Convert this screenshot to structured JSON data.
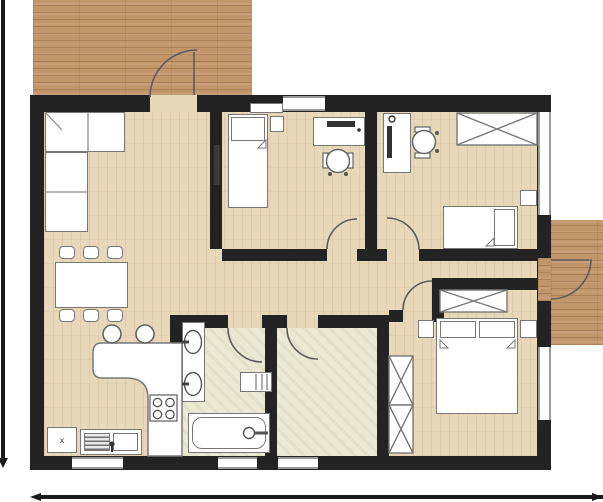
{
  "appliance": {
    "label": "x"
  },
  "colors": {
    "wall": "#232323",
    "deck": "#c2966b",
    "floor": "#e8d8ba",
    "bath": "#ebe9d4",
    "furnline": "#787878",
    "furnfill": "#ffffff",
    "winframe": "#9a9a9a",
    "dark": "#3a3a3a",
    "dim": "#1a1a1a"
  },
  "rooms": [
    "terrace",
    "living-dining-kitchen",
    "bedroom-1",
    "bedroom-2",
    "hallway",
    "bathroom",
    "utility-room",
    "master-bedroom",
    "balcony"
  ],
  "furniture_icons": [
    "corner-sofa",
    "tv",
    "dining-table",
    "dining-chair",
    "kitchen-counter",
    "bar-stool",
    "cooktop",
    "kitchen-sink",
    "dishwasher",
    "single-bed",
    "double-bed",
    "nightstand",
    "desk",
    "office-chair",
    "wardrobe",
    "double-washbasin",
    "bathtub",
    "towel-radiator"
  ]
}
